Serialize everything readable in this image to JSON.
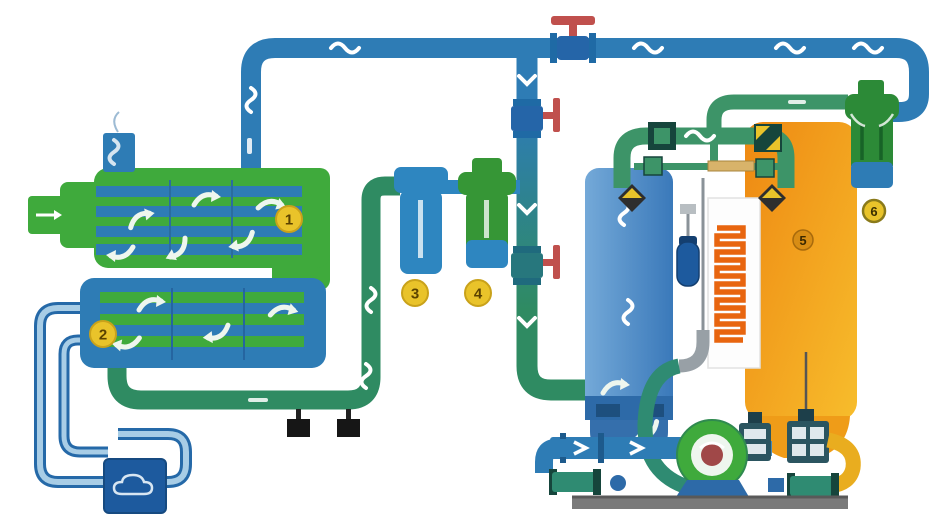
{
  "diagram": {
    "markers": [
      {
        "label": "1"
      },
      {
        "label": "2"
      },
      {
        "label": "3"
      },
      {
        "label": "4"
      },
      {
        "label": "5"
      },
      {
        "label": "6"
      }
    ],
    "colors": {
      "pipe_blue": "#2e7cb5",
      "pipe_teal": "#2f8b62",
      "machine_green": "#3faa3c",
      "tower_blue": "#3c7cbe",
      "tower_orange": "#f09b1d",
      "heater_orange": "#e8650f",
      "valve_red": "#c0504d",
      "marker_yellow": "#e9c32a",
      "base_gray": "#7a7a7a"
    }
  }
}
